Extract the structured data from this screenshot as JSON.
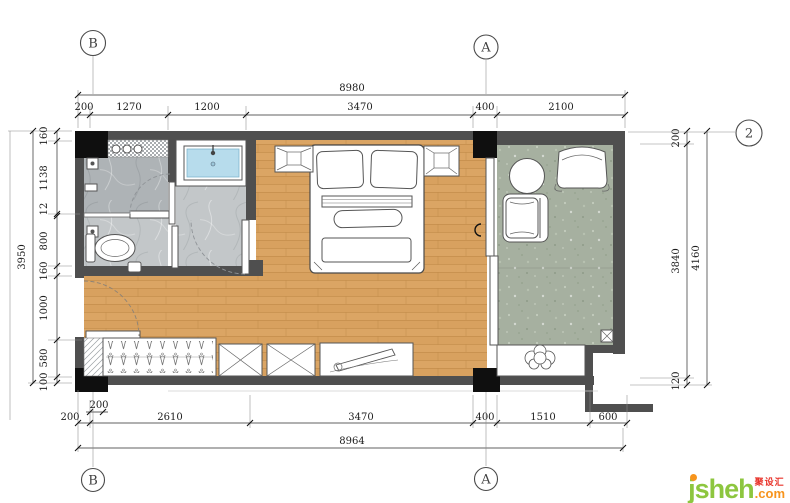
{
  "grid": {
    "b": "B",
    "a": "A",
    "two": "2"
  },
  "dims": {
    "top": {
      "overall": "8980",
      "segments": [
        "200",
        "1270",
        "1200",
        "3470",
        "400",
        "2100"
      ]
    },
    "bottom": {
      "overall": "8964",
      "offset": "200",
      "segments": [
        "200",
        "2610",
        "3470",
        "400",
        "1510",
        "600"
      ]
    },
    "left": {
      "overall": "3950",
      "segments": [
        "160",
        "1138",
        "12",
        "800",
        "160",
        "1000",
        "580",
        "100"
      ]
    },
    "right": {
      "overall": "4160",
      "segments": [
        "200",
        "3840",
        "120"
      ]
    }
  },
  "watermark": {
    "brand": "jsheh",
    "tld": ".com",
    "cn": "聚设汇"
  },
  "colors": {
    "wall": "#4f4f4f",
    "column": "#0f0f0f",
    "wood": "#d8a15f",
    "marble_dark": "#aeb3b6",
    "marble_light": "#c2c6c8",
    "balcony": "#a6b0a0",
    "basin": "#b7dcec",
    "brand_green": "#8dc63f",
    "brand_orange": "#f7941d",
    "brand_red": "#e8332a"
  }
}
